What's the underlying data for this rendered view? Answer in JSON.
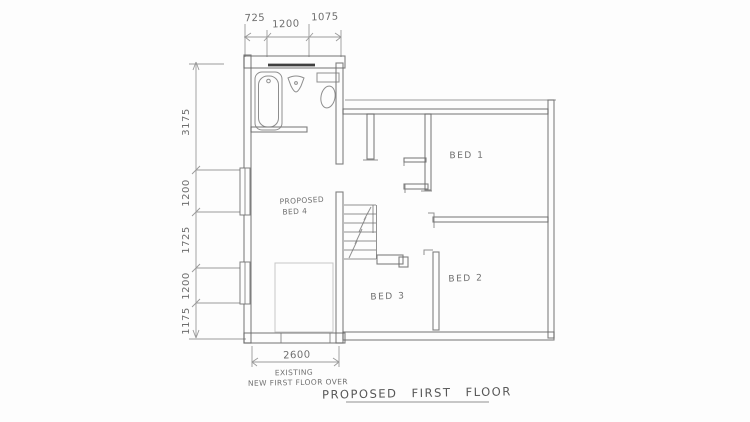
{
  "title": {
    "text": "PROPOSED FIRST FLOOR"
  },
  "rooms": {
    "bed1": "BED 1",
    "bed2": "BED 2",
    "bed3": "BED 3",
    "bed4_line1": "PROPOSED",
    "bed4_line2": "BED 4"
  },
  "dimensions": {
    "top": [
      "725",
      "1200",
      "1075"
    ],
    "left": [
      "3175",
      "1200",
      "1725",
      "1200",
      "1175"
    ],
    "bottom": "2600"
  },
  "annotations": {
    "existing": "EXISTING",
    "new_floor": "NEW FIRST FLOOR OVER"
  },
  "colors": {
    "pencil": "#6a6a6a",
    "pencil_light": "#9a9a9a",
    "pencil_dark": "#3f3f3f",
    "pencil_faint": "#c6c6c6",
    "paper": "#fdfdfd"
  }
}
